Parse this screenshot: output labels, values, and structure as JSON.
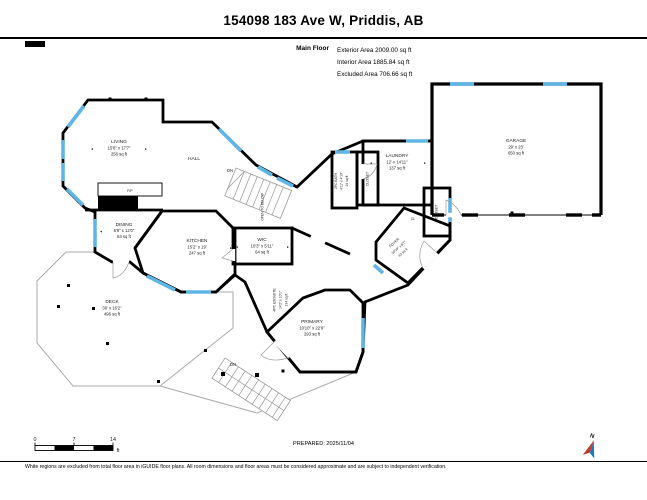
{
  "header": {
    "title": "154098 183 Ave W, Priddis, AB",
    "floor_label": "Main Floor",
    "exterior": "Exterior Area 2009.00 sq ft",
    "interior": "Interior Area 1885.84 sq ft",
    "excluded": "Excluded Area 706.66 sq ft"
  },
  "rooms": {
    "living": {
      "name": "LIVING",
      "dims": "15'8\" x 17'7\"",
      "area": "256 sq ft"
    },
    "hall": {
      "name": "HALL"
    },
    "dining": {
      "name": "DINING",
      "dims": "6'8\" x 12'0\"",
      "area": "84 sq ft"
    },
    "kitchen": {
      "name": "KITCHEN",
      "dims": "15'2\" x 19'",
      "area": "247 sq ft"
    },
    "wic": {
      "name": "WIC",
      "dims": "10'3\" x 5'11\"",
      "area": "64 sq ft"
    },
    "ensuite": {
      "name": "4PC ENSUITE",
      "dims": "14'2\" x 10'1\"",
      "area": "134 sq ft"
    },
    "primary": {
      "name": "PRIMARY",
      "dims": "10'10\" x 22'9\"",
      "area": "293 sq ft"
    },
    "bath": {
      "name": "2PC BATH",
      "dims": "4'11\" x 4'10\"",
      "area": "24 sq ft"
    },
    "laundry": {
      "name": "LAUNDRY",
      "dims": "12' x 14'11\"",
      "area": "137 sq ft"
    },
    "garage": {
      "name": "GARAGE",
      "dims": "29' x 23'",
      "area": "650 sq ft"
    },
    "foyer": {
      "name": "FOYER",
      "dims": "10'10\" x 6'7\"",
      "area": "62 sq ft"
    },
    "deck": {
      "name": "DECK",
      "dims": "30' x 16'2\"",
      "area": "496 sq ft"
    },
    "closet1": {
      "name": "CLOSET"
    },
    "closet2": {
      "name": "CLOSET"
    },
    "cl": {
      "name": "CL"
    },
    "fp": {
      "name": "F/P"
    },
    "open_below": {
      "name": "OPEN TO BELOW"
    }
  },
  "labels": {
    "dn": "DN",
    "north": "N"
  },
  "glyphs": {
    "l": "◄",
    "r": "►"
  },
  "scalebar": {
    "zero": "0",
    "mid": "7",
    "end": "14",
    "unit": "ft"
  },
  "footer": {
    "prepared": "PREPARED: 2025/11/04",
    "disclaimer": "White regions are excluded from total floor area in iGUIDE floor plans. All room dimensions and floor areas must be considered approximate and are subject to independent verification."
  },
  "colors": {
    "wall": "#000000",
    "window": "#5FB6E5",
    "room_fill": "#F5E3C0",
    "kitchen_fill": "#F2DCA9",
    "primary_fill": "#EDD9B5",
    "foyer_fill": "#E4E4E6",
    "compass_blue": "#1E7AB8",
    "compass_red": "#C23B2A"
  }
}
